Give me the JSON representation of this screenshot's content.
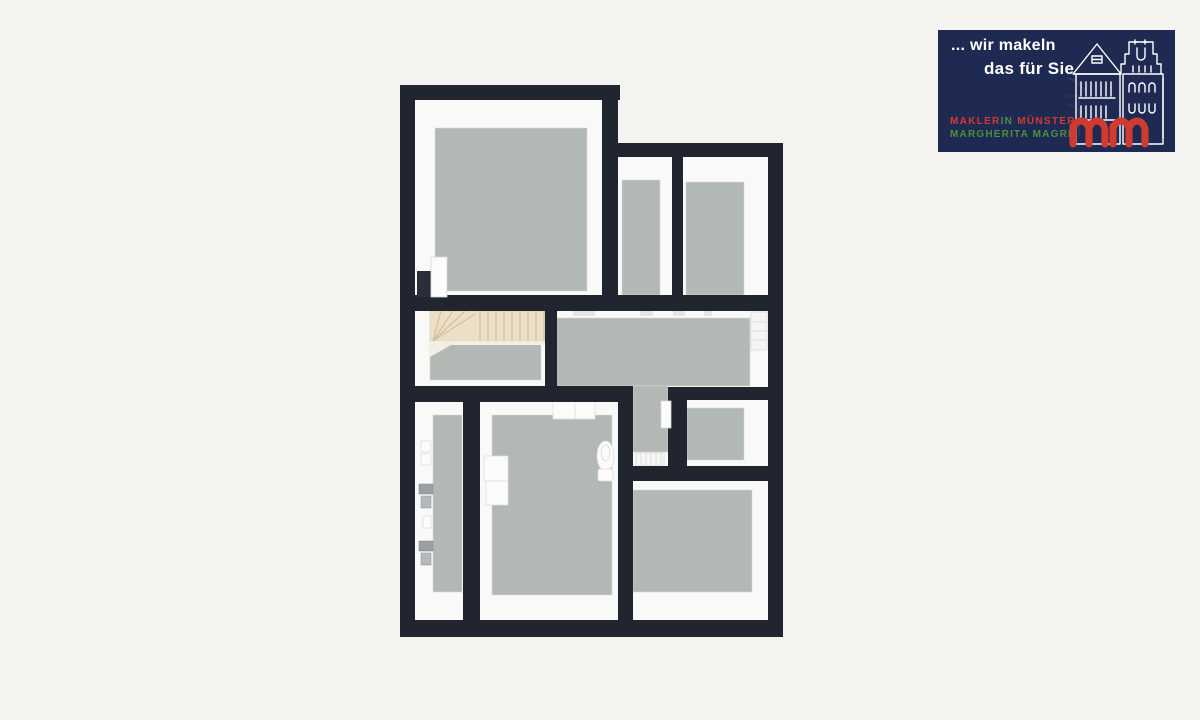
{
  "background_color": "#f4f3f0",
  "floorplan": {
    "wall_color": "#212530",
    "floor_color": "#b2b8b4",
    "wall_face_color": "#f9f9f7",
    "stairs_wood_color": "#ecdfc6",
    "rooms": [
      "room-top-left",
      "room-top-middle",
      "room-top-right",
      "stair-hall",
      "hallway",
      "corridor",
      "room-middle-right",
      "utility-room-narrow",
      "bathroom-middle",
      "room-bottom-right"
    ],
    "fixtures": [
      "staircase",
      "open-door-top-left",
      "door-middle-right",
      "radiator-hallway",
      "radiator-corridor",
      "toilet",
      "cabinet-left",
      "cabinet-top",
      "utility-connections"
    ]
  },
  "logo": {
    "bg_color": "#1e2a52",
    "tagline_line1": "... wir makeln",
    "tagline_line2": "das für Sie",
    "brand_line1": {
      "part1": "MAKLER",
      "part2": "IN",
      "part3": "MÜNSTER"
    },
    "brand_line2": "MARGHERITA MAGRI",
    "accent_red": "#d13a2f",
    "accent_green": "#4c8f3d",
    "monogram": "mm"
  }
}
